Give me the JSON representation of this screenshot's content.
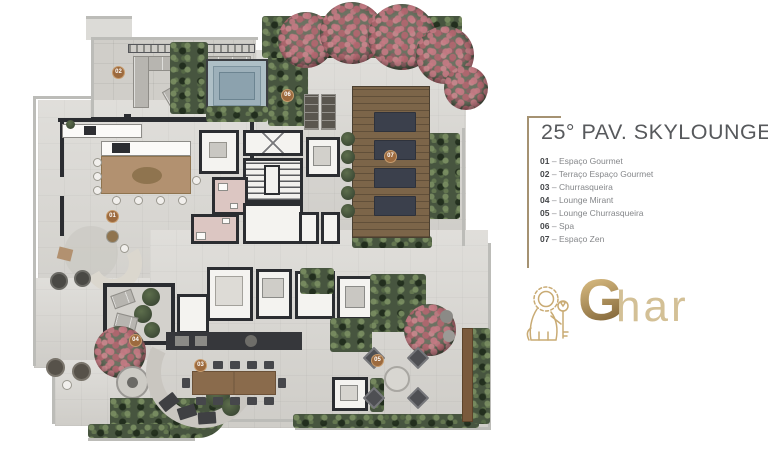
{
  "header": {
    "title": "25° PAV. SKYLOUNGE"
  },
  "legend": {
    "dash": "–",
    "items": [
      {
        "num": "01",
        "label": "Espaço Gourmet"
      },
      {
        "num": "02",
        "label": "Terraço Espaço Gourmet"
      },
      {
        "num": "03",
        "label": "Churrasqueira"
      },
      {
        "num": "04",
        "label": "Lounge Mirant"
      },
      {
        "num": "05",
        "label": "Lounge Churrasqueira"
      },
      {
        "num": "06",
        "label": "Spa"
      },
      {
        "num": "07",
        "label": "Espaço Zen"
      }
    ]
  },
  "logo": {
    "icon": "lion-with-key-icon",
    "text_bold": "G",
    "text_light": "har"
  },
  "colors": {
    "gold": "#a59272",
    "title_gray": "#57595c",
    "badge": "#9c6a3e",
    "wall": "#2b2d31",
    "floor": "#d7d5d0",
    "green": "#47553f",
    "wood": "#7c6549",
    "pool": "#8ca2ae",
    "bathroom_pink": "#dcc6c2"
  }
}
